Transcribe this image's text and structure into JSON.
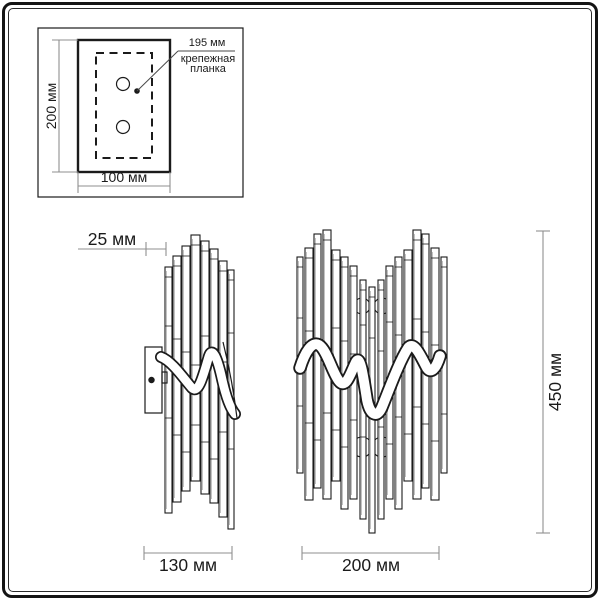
{
  "inset": {
    "annotation": {
      "value": "195 мм",
      "label_line1": "крепежная",
      "label_line2": "планка"
    },
    "height_label": "200 мм",
    "width_label": "100 мм"
  },
  "side_view": {
    "depth_label": "25 мм",
    "width_label": "130 мм"
  },
  "front_view": {
    "width_label": "200 мм",
    "height_label": "450 мм"
  },
  "colors": {
    "drawing_line": "#1b1b1b",
    "dimension_line": "#8f8f8f",
    "background": "#ffffff"
  },
  "drawing": {
    "side_rods": [
      {
        "x": 165,
        "w": 7,
        "top": 267,
        "bottom": 513
      },
      {
        "x": 173,
        "w": 8,
        "top": 256,
        "bottom": 502
      },
      {
        "x": 182,
        "w": 8,
        "top": 246,
        "bottom": 491
      },
      {
        "x": 191,
        "w": 9,
        "top": 235,
        "bottom": 481
      },
      {
        "x": 201,
        "w": 8,
        "top": 241,
        "bottom": 494
      },
      {
        "x": 210,
        "w": 8,
        "top": 249,
        "bottom": 503
      },
      {
        "x": 219,
        "w": 8,
        "top": 261,
        "bottom": 517
      },
      {
        "x": 228,
        "w": 6,
        "top": 270,
        "bottom": 529
      }
    ],
    "front_rods": [
      {
        "x": 297,
        "w": 6,
        "top": 257,
        "bottom": 473
      },
      {
        "x": 305,
        "w": 8,
        "top": 248,
        "bottom": 500
      },
      {
        "x": 314,
        "w": 7,
        "top": 234,
        "bottom": 488
      },
      {
        "x": 323,
        "w": 8,
        "top": 230,
        "bottom": 499
      },
      {
        "x": 332,
        "w": 8,
        "top": 250,
        "bottom": 481
      },
      {
        "x": 341,
        "w": 7,
        "top": 257,
        "bottom": 509
      },
      {
        "x": 350,
        "w": 7,
        "top": 266,
        "bottom": 499
      },
      {
        "x": 360,
        "w": 6,
        "top": 280,
        "bottom": 519
      },
      {
        "x": 369,
        "w": 6,
        "top": 287,
        "bottom": 533
      },
      {
        "x": 378,
        "w": 6,
        "top": 280,
        "bottom": 519
      },
      {
        "x": 386,
        "w": 7,
        "top": 266,
        "bottom": 499
      },
      {
        "x": 395,
        "w": 7,
        "top": 257,
        "bottom": 509
      },
      {
        "x": 404,
        "w": 8,
        "top": 250,
        "bottom": 481
      },
      {
        "x": 413,
        "w": 8,
        "top": 230,
        "bottom": 499
      },
      {
        "x": 422,
        "w": 7,
        "top": 234,
        "bottom": 488
      },
      {
        "x": 431,
        "w": 8,
        "top": 248,
        "bottom": 500
      },
      {
        "x": 441,
        "w": 6,
        "top": 257,
        "bottom": 473
      }
    ],
    "front_spheres": [
      {
        "cx": 362,
        "cy": 306,
        "r": 8
      },
      {
        "cx": 382,
        "cy": 306,
        "r": 8
      },
      {
        "cx": 362,
        "cy": 447,
        "r": 10
      },
      {
        "cx": 382,
        "cy": 447,
        "r": 10
      }
    ]
  }
}
